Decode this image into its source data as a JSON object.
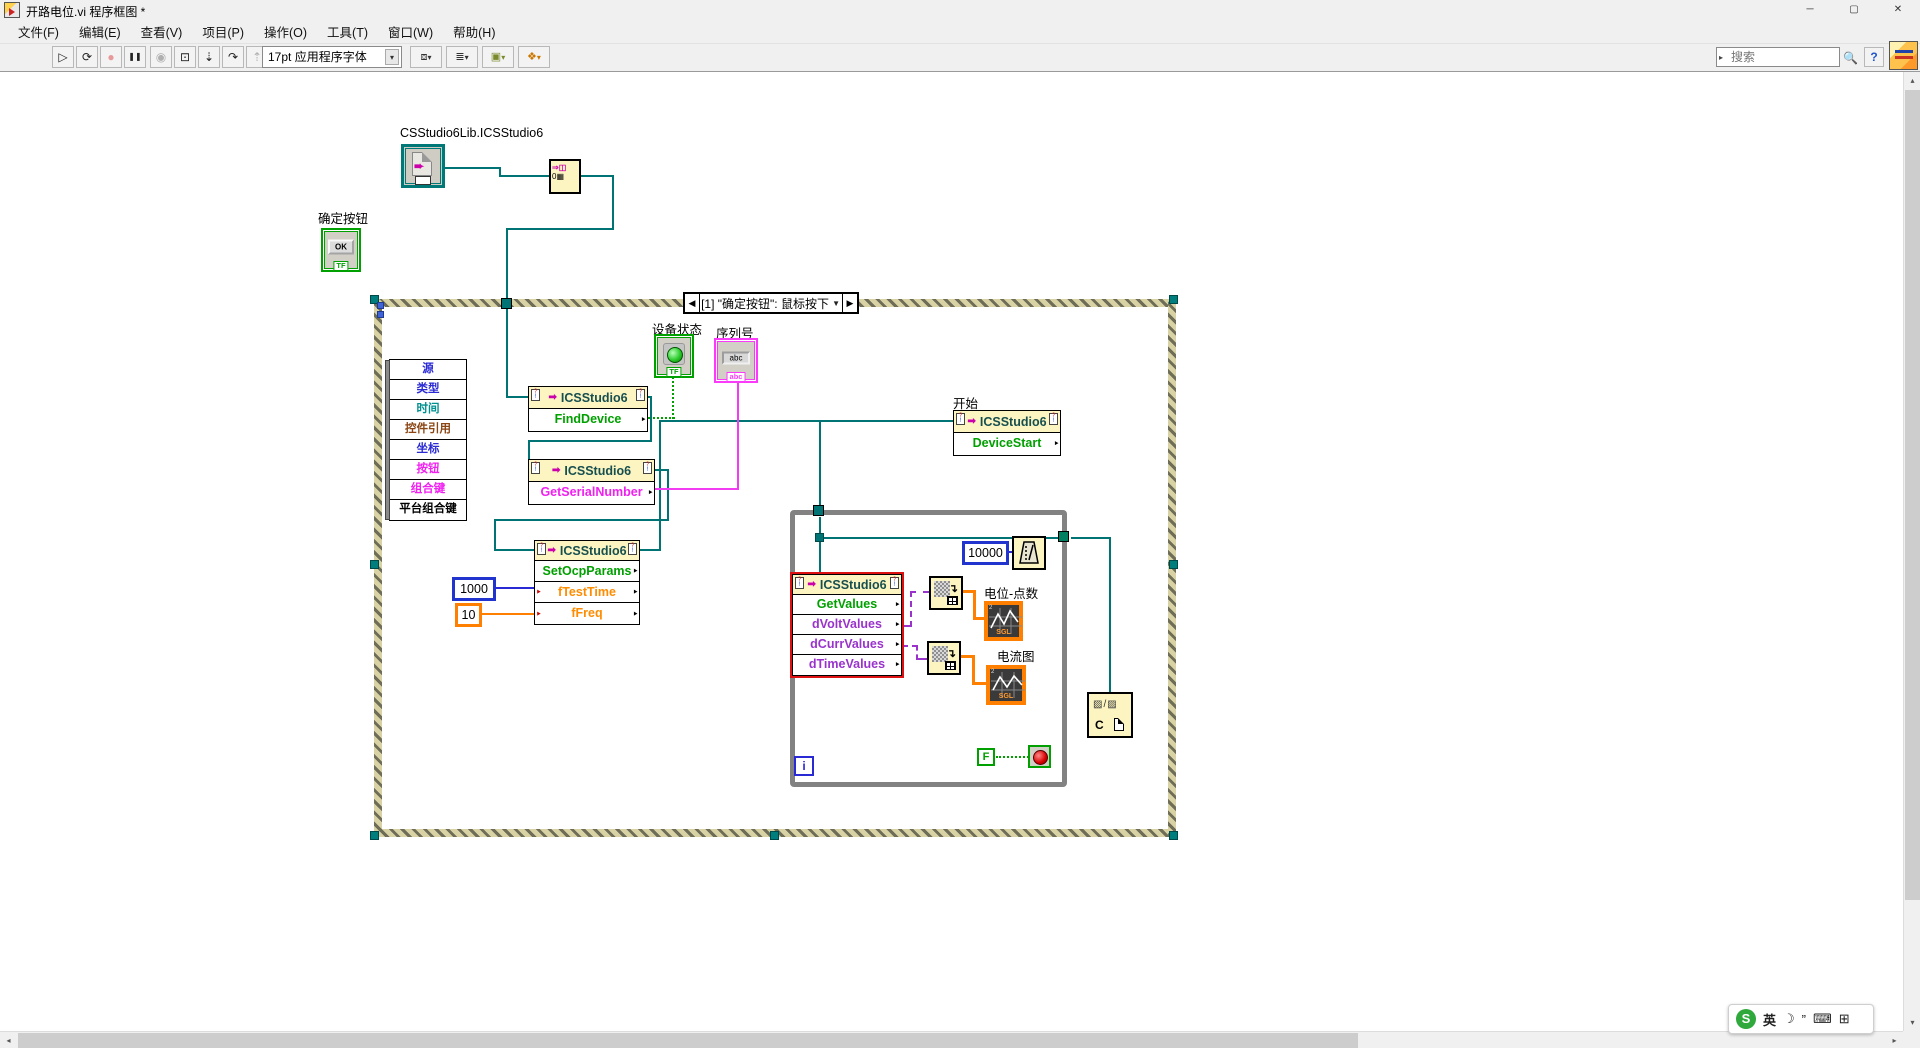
{
  "window": {
    "title": "开路电位.vi 程序框图 *",
    "minimize": "─",
    "maximize": "▢",
    "close": "✕"
  },
  "menu": {
    "items": [
      {
        "label": "文件(F)"
      },
      {
        "label": "编辑(E)"
      },
      {
        "label": "查看(V)"
      },
      {
        "label": "项目(P)"
      },
      {
        "label": "操作(O)"
      },
      {
        "label": "工具(T)"
      },
      {
        "label": "窗口(W)"
      },
      {
        "label": "帮助(H)"
      }
    ]
  },
  "toolbar": {
    "buttons": [
      {
        "name": "run",
        "glyph": "▷"
      },
      {
        "name": "run-continuous",
        "glyph": "⟳"
      },
      {
        "name": "abort",
        "glyph": "●"
      },
      {
        "name": "pause",
        "glyph": "❚❚"
      },
      {
        "name": "highlight-execution",
        "glyph": "◉"
      },
      {
        "name": "retain-wire-values",
        "glyph": "⊡"
      },
      {
        "name": "step-into",
        "glyph": "⇣"
      },
      {
        "name": "step-over",
        "glyph": "↷"
      },
      {
        "name": "step-out",
        "glyph": "⇡"
      }
    ],
    "font_selector": "17pt 应用程序字体",
    "dropdown_glyph": "▾",
    "align_glyph": "⧈",
    "distribute_glyph": "≣",
    "resize_glyph": "▣",
    "reorder_glyph": "❖",
    "search_placeholder": "搜索",
    "search_caret": "▸",
    "magnifier": "🔍",
    "help": "?"
  },
  "diagram": {
    "class_constant_label": "CSStudio6Lib.ICSStudio6",
    "constructor_glyph_top": "⇒◫",
    "constructor_glyph_bottom": "0▦",
    "ok_button": {
      "label": "确定按钮",
      "text": "OK",
      "bool": "TF"
    },
    "event_structure": {
      "prev": "◀",
      "index_label": "[1] \"确定按钮\": 鼠标按下",
      "dropdown": "▼",
      "next": "▶"
    },
    "event_data": {
      "items": [
        {
          "label": "源",
          "color": "#2a2ad4"
        },
        {
          "label": "类型",
          "color": "#2a2ad4"
        },
        {
          "label": "时间",
          "color": "#2a2ad4"
        },
        {
          "label": "控件引用",
          "color": "#009090"
        },
        {
          "label": "坐标",
          "color": "#8b4513"
        },
        {
          "label": "按钮",
          "color": "#2a2ad4"
        },
        {
          "label": "组合键",
          "color": "#f020f0"
        },
        {
          "label": "平台组合键",
          "color": "#f020f0"
        }
      ]
    },
    "device_status": {
      "label": "设备状态",
      "bool": "TF"
    },
    "serial_number": {
      "label": "序列号",
      "value": "abc",
      "tab": "abc"
    },
    "nodes": {
      "class_title": "ICSStudio6",
      "find_device": {
        "method": "FindDevice"
      },
      "get_serial_number": {
        "method": "GetSerialNumber"
      },
      "set_ocp_params": {
        "method": "SetOcpParams",
        "param1": "fTestTime",
        "param2": "fFreq"
      },
      "device_start": {
        "label": "开始",
        "method": "DeviceStart"
      },
      "get_values": {
        "method": "GetValues",
        "out1": "dVoltValues",
        "out2": "dCurrValues",
        "out3": "dTimeValues"
      }
    },
    "constants": {
      "test_time": "1000",
      "freq": "10",
      "wait_ms": "10000",
      "stop_false": "F"
    },
    "loop": {
      "iteration": "i"
    },
    "charts": {
      "volt": {
        "label": "电位-点数",
        "type_badge": "SGL",
        "tick": "2"
      },
      "curr": {
        "label": "电流图",
        "type_badge": "SGL",
        "tick": "2"
      }
    },
    "close_node": {
      "glyphs": "▨/▨",
      "letter": "C"
    },
    "colors": {
      "wire_ref": "#007474",
      "wire_bool": "#00a000",
      "wire_string": "#f23cf2",
      "wire_int": "#2a2ad4",
      "wire_float": "#ff8000",
      "wire_array": "#9933cc"
    }
  },
  "ime": {
    "brand": "S",
    "lang": "英",
    "moon": "☽",
    "quote": "”",
    "keyboard": "⌨",
    "grid": "⊞"
  }
}
